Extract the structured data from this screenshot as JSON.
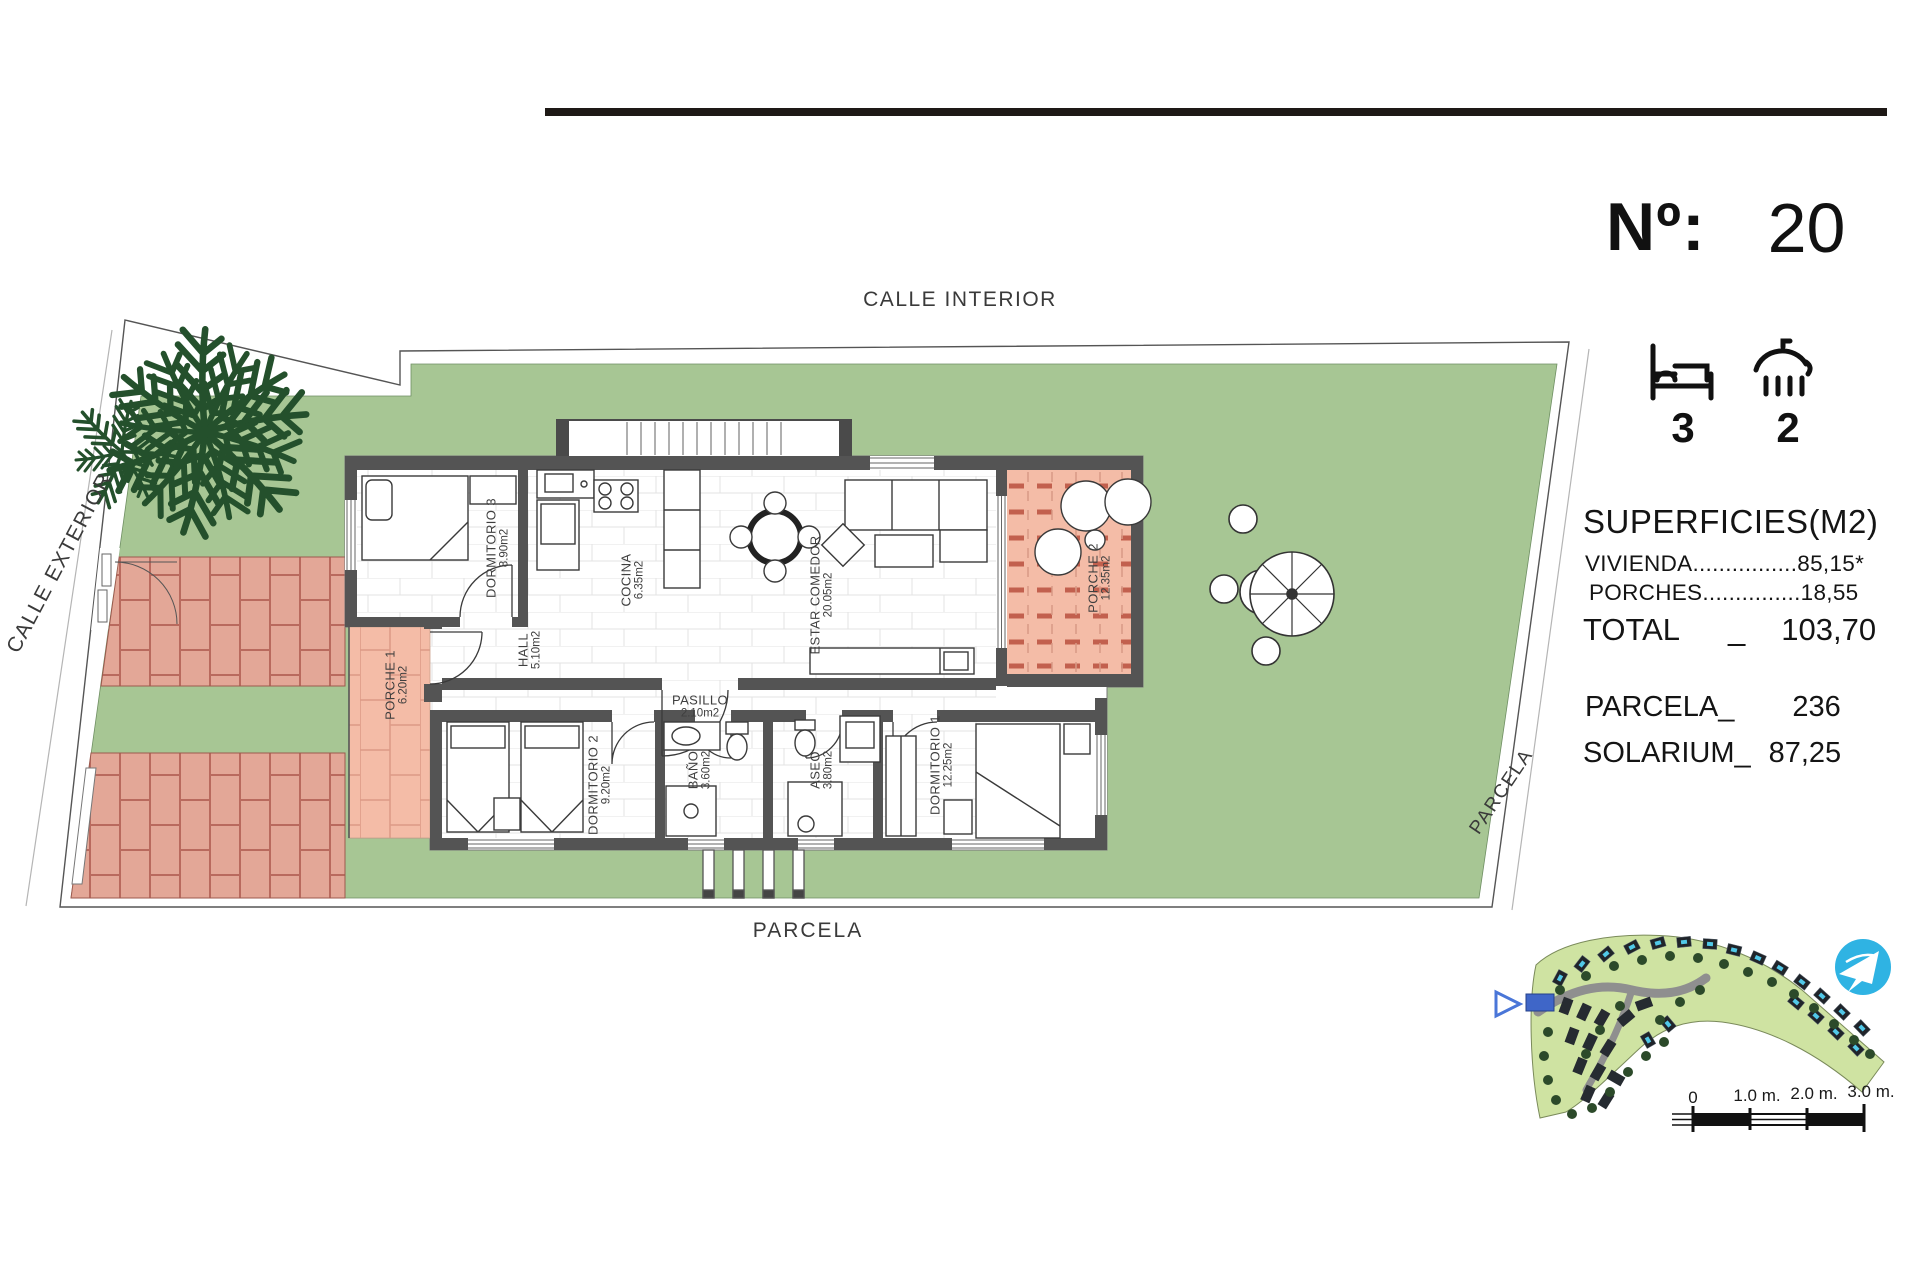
{
  "title_block": {
    "number_label": "Nº:",
    "number_value": "20",
    "bedrooms": "3",
    "bathrooms": "2"
  },
  "surfaces": {
    "title": "SUPERFICIES(M2)",
    "rows": [
      {
        "label": "VIVIENDA",
        "leader": "................",
        "value": "85,15*"
      },
      {
        "label": "PORCHES",
        "leader": "...............",
        "value": "18,55"
      }
    ],
    "total_label": "TOTAL",
    "total_sep": "_",
    "total_value": "103,70",
    "parcela_label": "PARCELA_",
    "parcela_value": "236",
    "solarium_label": "SOLARIUM_",
    "solarium_value": "87,25"
  },
  "street_labels": {
    "top": "CALLE INTERIOR",
    "left": "CALLE EXTERIOR",
    "bottom": "PARCELA",
    "right": "PARCELA"
  },
  "plan": {
    "rooms": [
      {
        "name": "DORMITORIO 3",
        "area": "8.90m2"
      },
      {
        "name": "COCINA",
        "area": "6.35m2"
      },
      {
        "name": "ESTAR COMEDOR",
        "area": "20.05m2"
      },
      {
        "name": "PORCHE 2",
        "area": "12.35m2"
      },
      {
        "name": "PORCHE 1",
        "area": "6.20m2"
      },
      {
        "name": "HALL",
        "area": "5.10m2"
      },
      {
        "name": "PASILLO",
        "area": "2.10m2"
      },
      {
        "name": "DORMITORIO 2",
        "area": "9.20m2"
      },
      {
        "name": "BAÑO",
        "area": "3.60m2"
      },
      {
        "name": "ASEO",
        "area": "3.80m2"
      },
      {
        "name": "DORMITORIO 1",
        "area": "12.25m2"
      }
    ]
  },
  "minimap": {
    "scale_labels": [
      "0",
      "1.0 m.",
      "2.0 m.",
      "3.0 m."
    ]
  },
  "colors": {
    "lawn_green": "#a7c694",
    "porch_salmon": "#f4bca7",
    "brick_fill": "#e3a797",
    "brick_joint": "#b96a5e",
    "wall_gray": "#545454",
    "palm_green": "#24502c",
    "map_green": "#cfe3a2",
    "logo_blue": "#2fb3e3",
    "highlight_blue": "#3f66c8"
  }
}
